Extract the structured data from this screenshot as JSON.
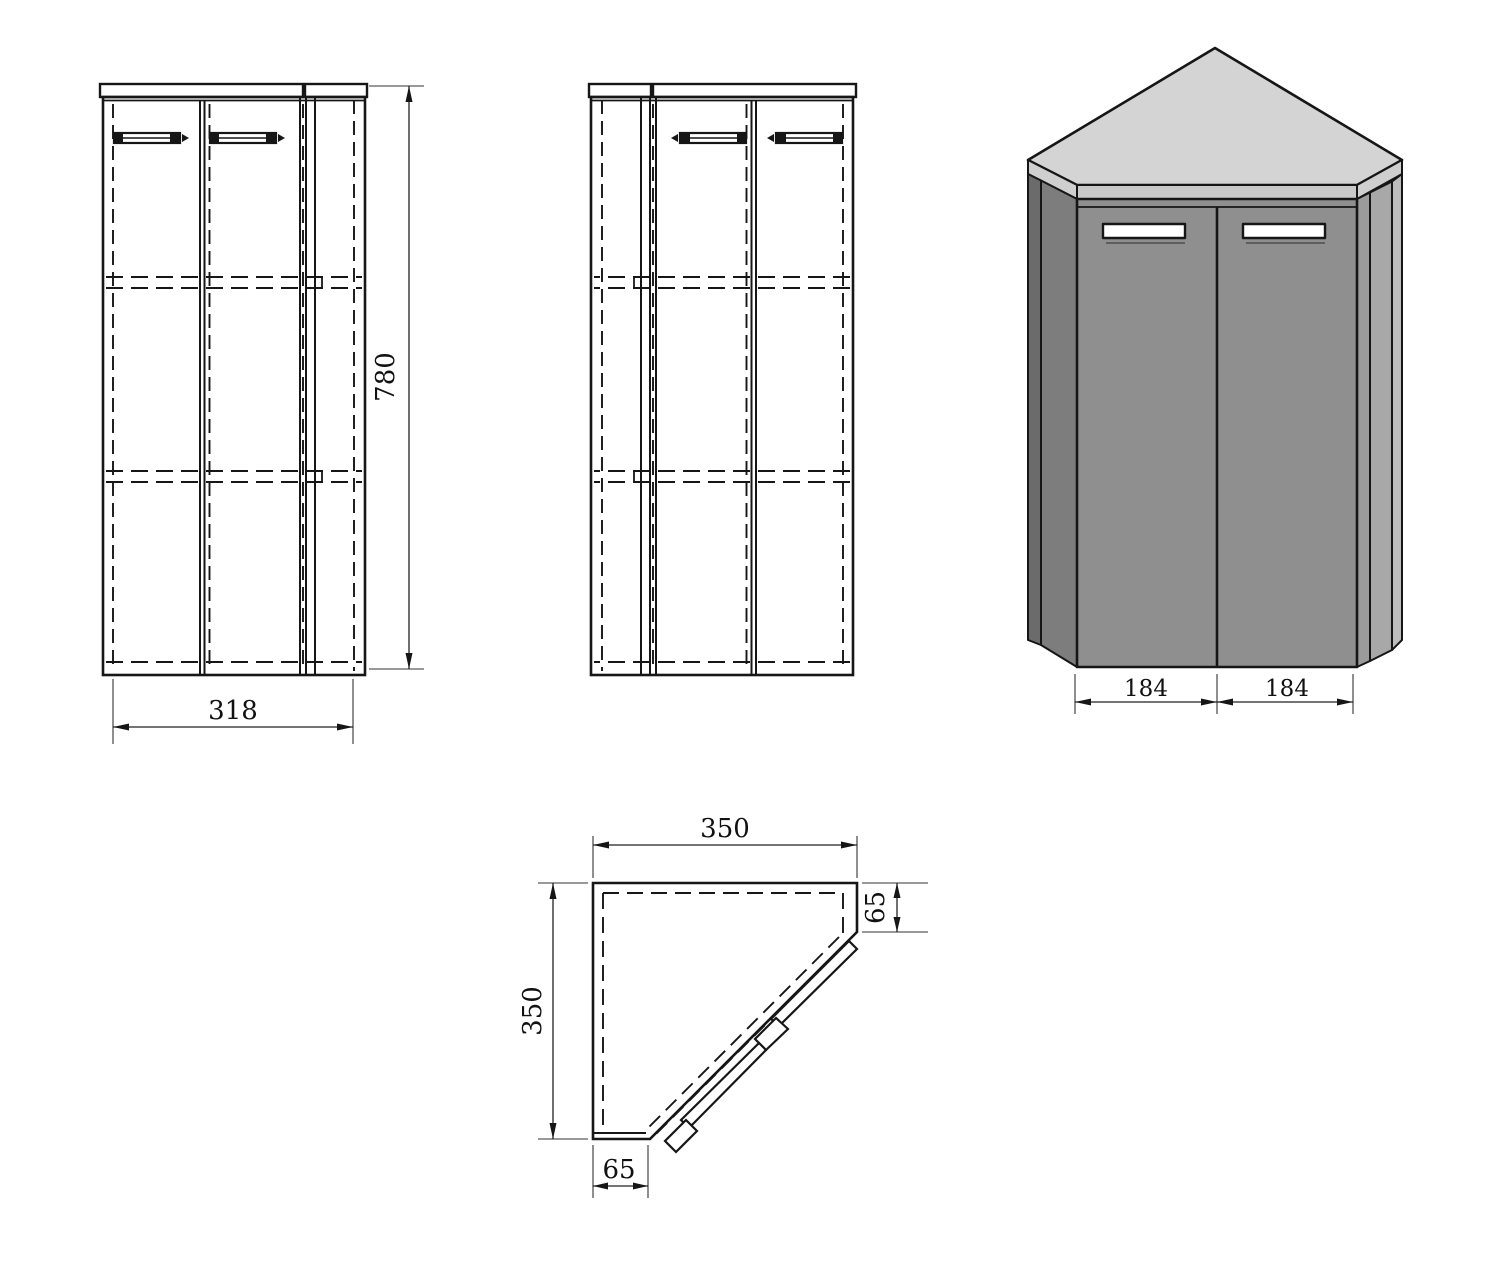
{
  "drawing": {
    "front_view": {
      "height": "780",
      "width": "318"
    },
    "iso_view": {
      "door_left": "184",
      "door_right": "184"
    },
    "plan_view": {
      "width": "350",
      "depth": "350",
      "side_right": "65",
      "side_bottom": "65"
    }
  },
  "colors": {
    "line": "#161616",
    "iso_top": "#d4d4d4",
    "iso_rim_front": "#c9c9c9",
    "iso_rim_side": "#cfcfcf",
    "iso_front": "#8f8f8f",
    "iso_left_dark": "#6b6b6b",
    "iso_left_mid": "#7d7d7d",
    "iso_right_strip": "#9b9b9b",
    "iso_right_panel": "#a8a8a8",
    "iso_right_edge": "#bdbdbd",
    "handle_fill": "#ffffff",
    "background": "#ffffff"
  }
}
